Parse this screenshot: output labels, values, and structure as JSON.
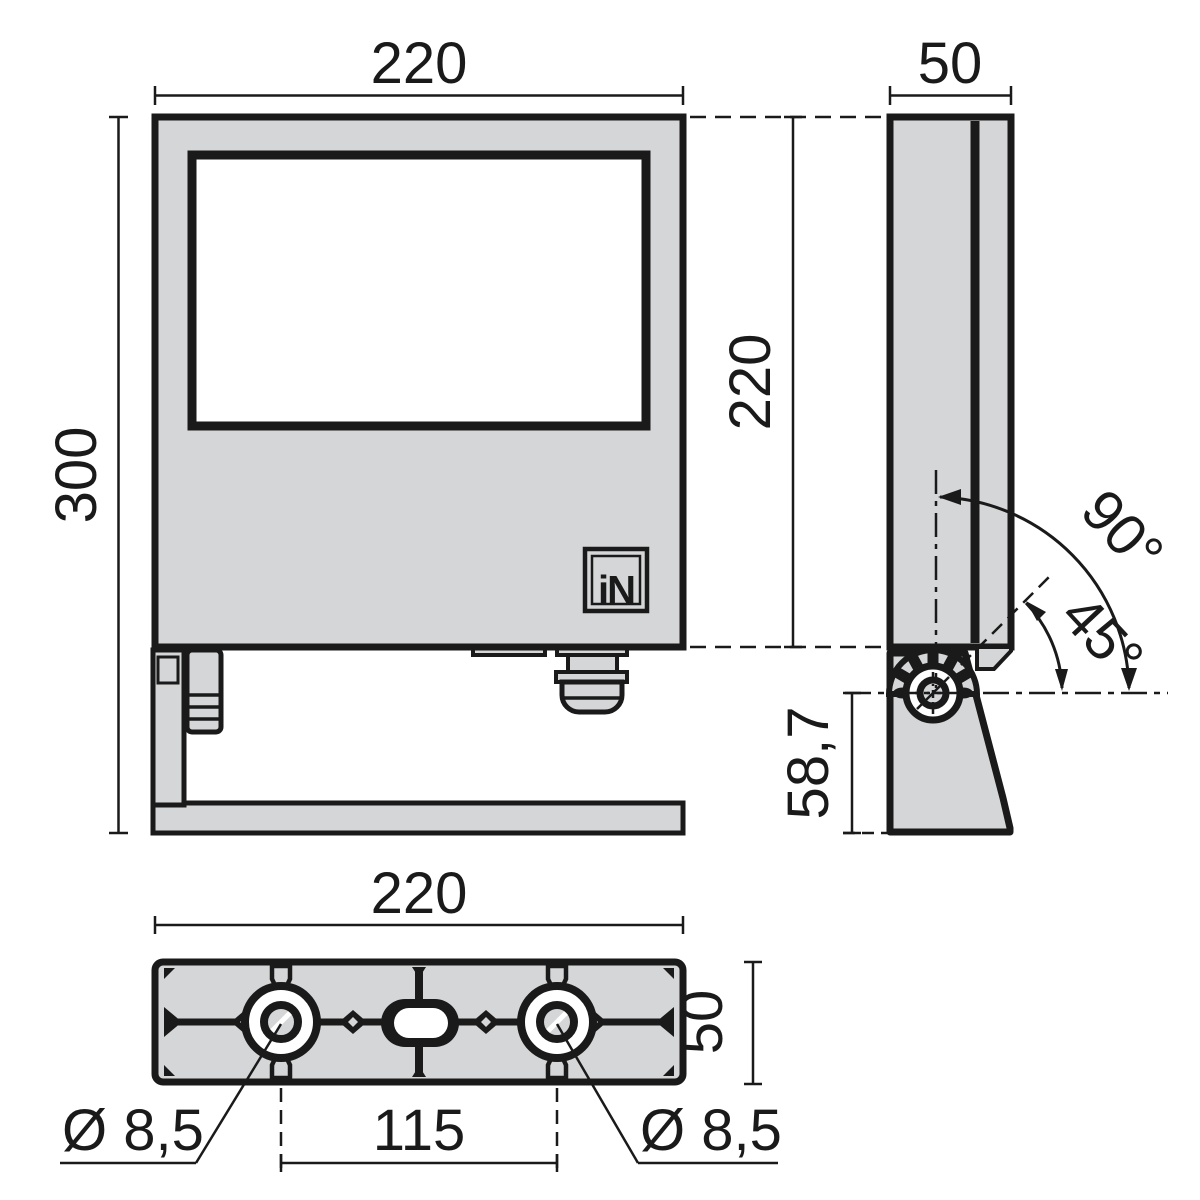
{
  "meta": {
    "drawing_type": "technical dimension drawing of floodlight luminaire with mounting bracket",
    "units": "mm",
    "views": [
      "front",
      "side",
      "bottom"
    ]
  },
  "colors": {
    "body_fill": "#d5d6d7",
    "line": "#1a1a1a",
    "background": "#ffffff"
  },
  "front_view": {
    "width": "220",
    "height": "300",
    "logo": "iN"
  },
  "side_view": {
    "depth": "50",
    "height": "220",
    "pivot_offset": "58,7",
    "angle_max": "90°",
    "angle_mid": "45°"
  },
  "bottom_view": {
    "width": "220",
    "depth": "50",
    "hole_spacing": "115",
    "hole_left": "Ø 8,5",
    "hole_right": "Ø 8,5"
  }
}
